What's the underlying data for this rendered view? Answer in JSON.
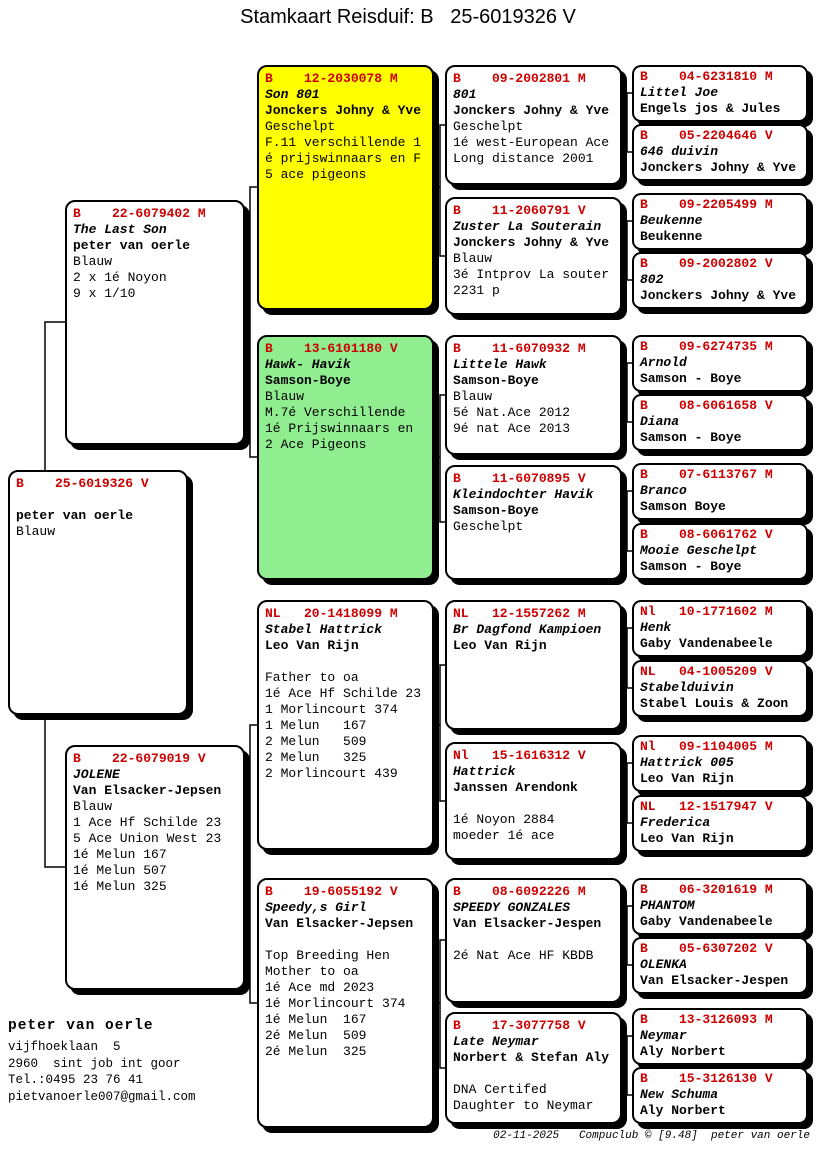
{
  "title": "Stamkaart Reisduif: B   25-6019326 V",
  "colors": {
    "accent": "#cc0000",
    "hl-yellow": "#ffff00",
    "hl-green": "#90ee90"
  },
  "cards": {
    "subject": {
      "ring": "B    25-6019326 V",
      "name": "",
      "fancier": "peter van oerle",
      "lines": [
        "Blauw"
      ]
    },
    "father": {
      "ring": "B    22-6079402 M",
      "name": "The Last Son",
      "fancier": "peter van oerle",
      "lines": [
        "Blauw",
        "2 x 1é Noyon",
        "9 x 1/10"
      ]
    },
    "mother": {
      "ring": "B    22-6079019 V",
      "name": "JOLENE",
      "fancier": "Van Elsacker-Jepsen",
      "lines": [
        "Blauw",
        "1 Ace Hf Schilde 23",
        "5 Ace Union West 23",
        "1é Melun 167",
        "1é Melun 507",
        "1é Melun 325"
      ]
    },
    "gp1": {
      "ring": "B    12-2030078 M",
      "name": "Son 801",
      "fancier": "Jonckers Johny & Yve",
      "lines": [
        "Geschelpt",
        "F.11 verschillende 1",
        "é prijswinnaars en F",
        "5 ace pigeons"
      ]
    },
    "gp2": {
      "ring": "B    13-6101180 V",
      "name": "Hawk- Havik",
      "fancier": "Samson-Boye",
      "lines": [
        "Blauw",
        "M.7é Verschillende",
        "1é Prijswinnaars en",
        "2 Ace Pigeons"
      ]
    },
    "gp3": {
      "ring": "NL   20-1418099 M",
      "name": "Stabel Hattrick",
      "fancier": "Leo Van Rijn",
      "lines": [
        "",
        "Father to oa",
        "1é Ace Hf Schilde 23",
        "1 Morlincourt 374",
        "1 Melun   167",
        "2 Melun   509",
        "2 Melun   325",
        "2 Morlincourt 439"
      ]
    },
    "gp4": {
      "ring": "B    19-6055192 V",
      "name": "Speedy,s Girl",
      "fancier": "Van Elsacker-Jepsen",
      "lines": [
        "",
        "Top Breeding Hen",
        "Mother to oa",
        "1é Ace md 2023",
        "1é Morlincourt 374",
        "1é Melun  167",
        "2é Melun  509",
        "2é Melun  325"
      ]
    },
    "ggp1": {
      "ring": "B    09-2002801 M",
      "name": "801",
      "fancier": "Jonckers Johny & Yve",
      "lines": [
        "Geschelpt",
        "1é west-European Ace",
        "Long distance 2001"
      ]
    },
    "ggp2": {
      "ring": "B    11-2060791 V",
      "name": "Zuster La Souterain",
      "fancier": "Jonckers Johny & Yve",
      "lines": [
        "Blauw",
        "3é Intprov La souter",
        "2231 p"
      ]
    },
    "ggp3": {
      "ring": "B    11-6070932 M",
      "name": "Littele Hawk",
      "fancier": "Samson-Boye",
      "lines": [
        "Blauw",
        "5é Nat.Ace 2012",
        "9é nat Ace 2013"
      ]
    },
    "ggp4": {
      "ring": "B    11-6070895 V",
      "name": "Kleindochter Havik",
      "fancier": "Samson-Boye",
      "lines": [
        "Geschelpt"
      ]
    },
    "ggp5": {
      "ring": "NL   12-1557262 M",
      "name": "Br Dagfond Kampioen",
      "fancier": "Leo Van Rijn",
      "lines": []
    },
    "ggp6": {
      "ring": "Nl   15-1616312 V",
      "name": "Hattrick",
      "fancier": "Janssen Arendonk",
      "lines": [
        "",
        "1é Noyon 2884",
        "moeder 1é ace"
      ]
    },
    "ggp7": {
      "ring": "B    08-6092226 M",
      "name": "SPEEDY GONZALES",
      "fancier": "Van Elsacker-Jespen",
      "lines": [
        "",
        "2é Nat Ace HF KBDB"
      ]
    },
    "ggp8": {
      "ring": "B    17-3077758 V",
      "name": "Late Neymar",
      "fancier": "Norbert & Stefan Aly",
      "lines": [
        "",
        "DNA Certifed",
        "Daughter to Neymar"
      ]
    },
    "g1": {
      "ring": "B    04-6231810 M",
      "name": "Littel Joe",
      "fancier": "Engels jos & Jules"
    },
    "g2": {
      "ring": "B    05-2204646 V",
      "name": "646 duivin",
      "fancier": "Jonckers Johny & Yve"
    },
    "g3": {
      "ring": "B    09-2205499 M",
      "name": "Beukenne",
      "fancier": "Beukenne"
    },
    "g4": {
      "ring": "B    09-2002802 V",
      "name": "802",
      "fancier": "Jonckers Johny & Yve"
    },
    "g5": {
      "ring": "B    09-6274735 M",
      "name": "Arnold",
      "fancier": "Samson - Boye"
    },
    "g6": {
      "ring": "B    08-6061658 V",
      "name": "Diana",
      "fancier": "Samson - Boye"
    },
    "g7": {
      "ring": "B    07-6113767 M",
      "name": "Branco",
      "fancier": "Samson Boye"
    },
    "g8": {
      "ring": "B    08-6061762 V",
      "name": "Mooie Geschelpt",
      "fancier": "Samson - Boye"
    },
    "g9": {
      "ring": "Nl   10-1771602 M",
      "name": "Henk",
      "fancier": "Gaby Vandenabeele"
    },
    "g10": {
      "ring": "NL   04-1005209 V",
      "name": "Stabelduivin",
      "fancier": "Stabel Louis & Zoon"
    },
    "g11": {
      "ring": "Nl   09-1104005 M",
      "name": "Hattrick 005",
      "fancier": "Leo Van Rijn"
    },
    "g12": {
      "ring": "NL   12-1517947 V",
      "name": "Frederica",
      "fancier": "Leo Van Rijn"
    },
    "g13": {
      "ring": "B    06-3201619 M",
      "name": "PHANTOM",
      "fancier": "Gaby Vandenabeele"
    },
    "g14": {
      "ring": "B    05-6307202 V",
      "name": "OLENKA",
      "fancier": "Van Elsacker-Jespen"
    },
    "g15": {
      "ring": "B    13-3126093 M",
      "name": "Neymar",
      "fancier": "Aly Norbert"
    },
    "g16": {
      "ring": "B    15-3126130 V",
      "name": "New Schuma",
      "fancier": "Aly Norbert"
    }
  },
  "owner": {
    "name": "peter van oerle",
    "lines": [
      "vijfhoeklaan  5",
      "2960  sint job int goor",
      "Tel.:0495 23 76 41",
      "pietvanoerle007@gmail.com"
    ]
  },
  "print_footer": "02-11-2025   Compuclub © [9.48]  peter van oerle"
}
